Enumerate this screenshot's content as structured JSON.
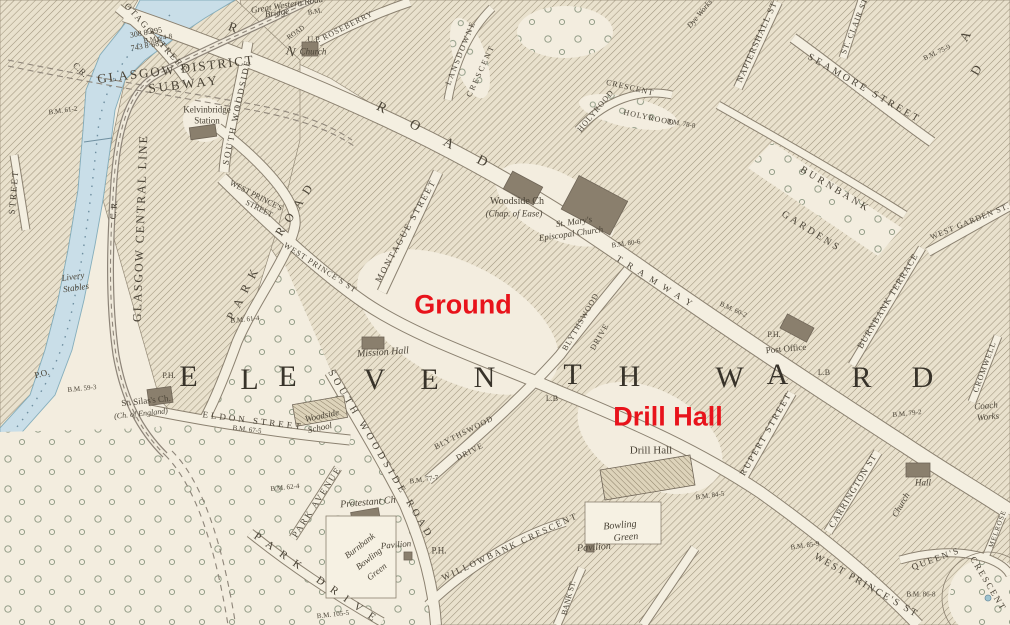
{
  "map": {
    "red_annotations": {
      "ground": "Ground",
      "drill_hall": "Drill Hall"
    },
    "ward_text": "ELEVENTH WARD",
    "colors": {
      "paper": "#f3eddf",
      "ink": "#4a4336",
      "water": "#c9dee8",
      "hatch": "#a0957e",
      "annotation_red": "#e8131b"
    },
    "labels": [
      {
        "name": "otago-street",
        "text": "OTAGO STREET",
        "x": 156,
        "y": 38,
        "rot": 48,
        "fs": 9,
        "ls": 2
      },
      {
        "name": "left-street",
        "text": "STREET",
        "x": 14,
        "y": 192,
        "rot": -85,
        "fs": 9,
        "ls": 2
      },
      {
        "name": "cr-upper",
        "text": "C.R.",
        "x": 80,
        "y": 70,
        "rot": 45,
        "fs": 9
      },
      {
        "name": "subway-line1",
        "text": "GLASGOW DISTRICT",
        "x": 176,
        "y": 69,
        "rot": -7,
        "fs": 13,
        "ls": 2
      },
      {
        "name": "subway-line2",
        "text": "SUBWAY",
        "x": 184,
        "y": 84,
        "rot": -7,
        "fs": 13,
        "ls": 3
      },
      {
        "name": "plot-308",
        "text": "308 8·895",
        "x": 146,
        "y": 33,
        "rot": -10,
        "fs": 8
      },
      {
        "name": "bm-74-8",
        "text": "B.M. 74-8",
        "x": 158,
        "y": 39,
        "rot": -10,
        "fs": 7
      },
      {
        "name": "plot-743",
        "text": "743 8·885",
        "x": 147,
        "y": 46,
        "rot": -10,
        "fs": 8
      },
      {
        "name": "bm-61-2",
        "text": "B.M. 61-2",
        "x": 63,
        "y": 111,
        "rot": -8,
        "fs": 7
      },
      {
        "name": "great-western-road",
        "text": "Great Western Road",
        "x": 287,
        "y": 5,
        "rot": -9,
        "fs": 9,
        "style": "it"
      },
      {
        "name": "gwr-bridge",
        "text": "Bridge",
        "x": 277,
        "y": 13,
        "rot": -9,
        "fs": 9,
        "style": "it"
      },
      {
        "name": "gwr-bridge-bm",
        "text": "B.M.",
        "x": 315,
        "y": 12,
        "rot": -9,
        "fs": 7
      },
      {
        "name": "roseberry",
        "text": "ROSEBERRY",
        "x": 348,
        "y": 26,
        "rot": -27,
        "fs": 8,
        "ls": 1
      },
      {
        "name": "road-small",
        "text": "ROAD",
        "x": 296,
        "y": 33,
        "rot": -35,
        "fs": 7
      },
      {
        "name": "up-church-1",
        "text": "U.P.",
        "x": 314,
        "y": 40,
        "rot": 0,
        "fs": 8
      },
      {
        "name": "up-church-2",
        "text": "Church",
        "x": 313,
        "y": 52,
        "rot": 0,
        "fs": 9,
        "style": "it"
      },
      {
        "name": "gwr-letter-r",
        "text": "R",
        "x": 233,
        "y": 27,
        "rot": 20,
        "fs": 13
      },
      {
        "name": "gwr-letter-n",
        "text": "N",
        "x": 291,
        "y": 51,
        "rot": 20,
        "fs": 13
      },
      {
        "name": "lansdowne-1",
        "text": "LANSDOWNE",
        "x": 461,
        "y": 53,
        "rot": -68,
        "fs": 8,
        "ls": 2
      },
      {
        "name": "lansdowne-2",
        "text": "CRESCENT",
        "x": 481,
        "y": 71,
        "rot": -65,
        "fs": 8,
        "ls": 2
      },
      {
        "name": "cr-mid",
        "text": "C. R.",
        "x": 114,
        "y": 210,
        "rot": -85,
        "fs": 9
      },
      {
        "name": "glasgow-central-line",
        "text": "GLASGOW CENTRAL LINE",
        "x": 140,
        "y": 228,
        "rot": -88,
        "fs": 12,
        "ls": 2
      },
      {
        "name": "kelvinbridge-station-1",
        "text": "Kelvinbridge",
        "x": 207,
        "y": 110,
        "rot": 0,
        "fs": 9
      },
      {
        "name": "kelvinbridge-station-2",
        "text": "Station",
        "x": 207,
        "y": 121,
        "rot": 0,
        "fs": 9
      },
      {
        "name": "south-woodside",
        "text": "SOUTH WOODSIDE",
        "x": 237,
        "y": 112,
        "rot": -78,
        "fs": 9,
        "ls": 2
      },
      {
        "name": "park-road-1",
        "text": "ROAD",
        "x": 296,
        "y": 207,
        "rot": -57,
        "fs": 12,
        "ls": 8
      },
      {
        "name": "park-road-2",
        "text": "PARK",
        "x": 244,
        "y": 291,
        "rot": -63,
        "fs": 12,
        "ls": 8
      },
      {
        "name": "west-princes-street-1a",
        "text": "WEST PRINCE'S",
        "x": 256,
        "y": 196,
        "rot": 27,
        "fs": 8
      },
      {
        "name": "west-princes-street-1b",
        "text": "STREET",
        "x": 259,
        "y": 209,
        "rot": 27,
        "fs": 8
      },
      {
        "name": "gwr-road-letters",
        "text": "ROAD",
        "x": 444,
        "y": 142,
        "rot": 28,
        "fs": 14,
        "ls": 28
      },
      {
        "name": "west-princes-st-2",
        "text": "WEST PRINCE'S ST",
        "x": 320,
        "y": 268,
        "rot": 33,
        "fs": 8,
        "ls": 1
      },
      {
        "name": "montague-street",
        "text": "MONTAGUE STREET",
        "x": 406,
        "y": 231,
        "rot": -61,
        "fs": 9,
        "ls": 2
      },
      {
        "name": "woodside-church",
        "text": "Woodside Ch",
        "x": 517,
        "y": 202,
        "rot": 0,
        "fs": 10
      },
      {
        "name": "chap-of-ease",
        "text": "(Chap. of Ease)",
        "x": 514,
        "y": 214,
        "rot": 0,
        "fs": 9,
        "style": "it"
      },
      {
        "name": "st-marys-1",
        "text": "St. Mary's",
        "x": 574,
        "y": 222,
        "rot": -8,
        "fs": 9,
        "style": "it"
      },
      {
        "name": "st-marys-2",
        "text": "Episcopal Church",
        "x": 571,
        "y": 234,
        "rot": -8,
        "fs": 9,
        "style": "it"
      },
      {
        "name": "bm-80-6",
        "text": "B.M. 80-6",
        "x": 626,
        "y": 244,
        "rot": -8,
        "fs": 7
      },
      {
        "name": "tramway",
        "text": "TRAMWAY",
        "x": 657,
        "y": 283,
        "rot": 32,
        "fs": 9,
        "ls": 7
      },
      {
        "name": "bm-60-2",
        "text": "B.M. 60-2",
        "x": 733,
        "y": 310,
        "rot": 25,
        "fs": 7
      },
      {
        "name": "ph-post-office",
        "text": "P.H.",
        "x": 774,
        "y": 335,
        "rot": 0,
        "fs": 8
      },
      {
        "name": "post-office",
        "text": "Post Office",
        "x": 786,
        "y": 349,
        "rot": -5,
        "fs": 9
      },
      {
        "name": "letter-box-1",
        "text": "L.B",
        "x": 552,
        "y": 399,
        "rot": 0,
        "fs": 8
      },
      {
        "name": "letter-box-2",
        "text": "L.B",
        "x": 824,
        "y": 373,
        "rot": 0,
        "fs": 8
      },
      {
        "name": "blythswood-n",
        "text": "BLYTHSWOOD",
        "x": 581,
        "y": 322,
        "rot": -60,
        "fs": 8,
        "ls": 1
      },
      {
        "name": "blythswood-n-drive",
        "text": "DRIVE",
        "x": 600,
        "y": 337,
        "rot": -60,
        "fs": 8,
        "ls": 1
      },
      {
        "name": "ward-letter-e1",
        "text": "E",
        "x": 189,
        "y": 377,
        "rot": 0,
        "fs": 30,
        "style": "ward"
      },
      {
        "name": "ward-letter-l",
        "text": "L",
        "x": 250,
        "y": 380,
        "rot": 0,
        "fs": 30,
        "style": "ward"
      },
      {
        "name": "ward-letter-e2",
        "text": "E",
        "x": 288,
        "y": 377,
        "rot": 0,
        "fs": 30,
        "style": "ward"
      },
      {
        "name": "ward-letter-v",
        "text": "V",
        "x": 375,
        "y": 380,
        "rot": 0,
        "fs": 30,
        "style": "ward"
      },
      {
        "name": "ward-letter-e3",
        "text": "E",
        "x": 430,
        "y": 380,
        "rot": 0,
        "fs": 30,
        "style": "ward"
      },
      {
        "name": "ward-letter-n",
        "text": "N",
        "x": 485,
        "y": 378,
        "rot": 0,
        "fs": 30,
        "style": "ward"
      },
      {
        "name": "ward-letter-t",
        "text": "T",
        "x": 573,
        "y": 375,
        "rot": 0,
        "fs": 30,
        "style": "ward"
      },
      {
        "name": "ward-letter-h",
        "text": "H",
        "x": 630,
        "y": 377,
        "rot": 0,
        "fs": 30,
        "style": "ward"
      },
      {
        "name": "ward-letter-w",
        "text": "W",
        "x": 730,
        "y": 378,
        "rot": 0,
        "fs": 30,
        "style": "ward"
      },
      {
        "name": "ward-letter-a",
        "text": "A",
        "x": 778,
        "y": 375,
        "rot": 0,
        "fs": 30,
        "style": "ward"
      },
      {
        "name": "ward-letter-r",
        "text": "R",
        "x": 862,
        "y": 378,
        "rot": 0,
        "fs": 30,
        "style": "ward"
      },
      {
        "name": "ward-letter-d",
        "text": "D",
        "x": 923,
        "y": 378,
        "rot": 0,
        "fs": 30,
        "style": "ward"
      },
      {
        "name": "mission-hall",
        "text": "Mission Hall",
        "x": 383,
        "y": 353,
        "rot": -4,
        "fs": 10,
        "style": "it"
      },
      {
        "name": "eldon-street",
        "text": "ELDON STREET",
        "x": 253,
        "y": 421,
        "rot": 7,
        "fs": 9,
        "ls": 3
      },
      {
        "name": "bm-67-5",
        "text": "B.M. 67-5",
        "x": 247,
        "y": 430,
        "rot": 7,
        "fs": 7
      },
      {
        "name": "woodside-school-1",
        "text": "Woodside",
        "x": 322,
        "y": 416,
        "rot": -12,
        "fs": 9,
        "style": "it"
      },
      {
        "name": "woodside-school-2",
        "text": "School",
        "x": 320,
        "y": 428,
        "rot": -12,
        "fs": 9,
        "style": "it"
      },
      {
        "name": "st-silas-1",
        "text": "St. Silas's Ch.",
        "x": 146,
        "y": 401,
        "rot": -6,
        "fs": 9
      },
      {
        "name": "st-silas-2",
        "text": "(Ch. of England)",
        "x": 141,
        "y": 414,
        "rot": -6,
        "fs": 8,
        "style": "it"
      },
      {
        "name": "post-office-west",
        "text": "P.O.",
        "x": 42,
        "y": 374,
        "rot": -15,
        "fs": 9
      },
      {
        "name": "bm-59-3",
        "text": "B.M. 59-3",
        "x": 82,
        "y": 389,
        "rot": -6,
        "fs": 7
      },
      {
        "name": "ph-west",
        "text": "P.H.",
        "x": 169,
        "y": 376,
        "rot": 0,
        "fs": 8
      },
      {
        "name": "livery-stables-1",
        "text": "Livery",
        "x": 73,
        "y": 277,
        "rot": -8,
        "fs": 9,
        "style": "it"
      },
      {
        "name": "livery-stables-2",
        "text": "Stables",
        "x": 76,
        "y": 288,
        "rot": -8,
        "fs": 9,
        "style": "it"
      },
      {
        "name": "south-woodside-road",
        "text": "SOUTH WOODSIDE ROAD",
        "x": 380,
        "y": 455,
        "rot": 59,
        "fs": 10,
        "ls": 4
      },
      {
        "name": "blythswood-s",
        "text": "BLYTHSWOOD",
        "x": 464,
        "y": 433,
        "rot": -27,
        "fs": 8,
        "ls": 1
      },
      {
        "name": "blythswood-s-drive",
        "text": "DRIVE",
        "x": 470,
        "y": 452,
        "rot": -27,
        "fs": 8,
        "ls": 1
      },
      {
        "name": "bm-77-7",
        "text": "B.M. 77-7",
        "x": 424,
        "y": 480,
        "rot": -8,
        "fs": 7
      },
      {
        "name": "park-avenue",
        "text": "PARK AVENUE",
        "x": 317,
        "y": 502,
        "rot": -57,
        "fs": 9,
        "ls": 2
      },
      {
        "name": "protestant-church",
        "text": "Protestant Ch",
        "x": 368,
        "y": 503,
        "rot": -5,
        "fs": 10,
        "style": "it"
      },
      {
        "name": "burnbank-bowling-1",
        "text": "Burnbank",
        "x": 360,
        "y": 546,
        "rot": -38,
        "fs": 9,
        "style": "it"
      },
      {
        "name": "burnbank-bowling-2",
        "text": "Bowling",
        "x": 369,
        "y": 559,
        "rot": -38,
        "fs": 9,
        "style": "it"
      },
      {
        "name": "burnbank-bowling-3",
        "text": "Green",
        "x": 377,
        "y": 572,
        "rot": -38,
        "fs": 9,
        "style": "it"
      },
      {
        "name": "pavilion-west",
        "text": "Pavilion",
        "x": 396,
        "y": 545,
        "rot": -5,
        "fs": 9,
        "style": "it"
      },
      {
        "name": "ph-center",
        "text": "P.H.",
        "x": 439,
        "y": 551,
        "rot": 0,
        "fs": 9
      },
      {
        "name": "willowbank-crescent",
        "text": "WILLOWBANK CRESCENT",
        "x": 510,
        "y": 547,
        "rot": -25,
        "fs": 9,
        "ls": 2
      },
      {
        "name": "bank-st",
        "text": "BANK ST.",
        "x": 569,
        "y": 598,
        "rot": -75,
        "fs": 8
      },
      {
        "name": "park-drive",
        "text": "PARK DRIVE",
        "x": 318,
        "y": 580,
        "rot": 35,
        "fs": 11,
        "ls": 9
      },
      {
        "name": "bm-105-5",
        "text": "B.M. 105-5",
        "x": 333,
        "y": 615,
        "rot": -6,
        "fs": 7
      },
      {
        "name": "bm-62-4",
        "text": "B.M. 62-4",
        "x": 285,
        "y": 488,
        "rot": -6,
        "fs": 7
      },
      {
        "name": "bm-61-4",
        "text": "B.M. 61-4",
        "x": 245,
        "y": 320,
        "rot": -6,
        "fs": 7
      },
      {
        "name": "drill-hall-building-label",
        "text": "Drill Hall",
        "x": 651,
        "y": 451,
        "rot": 0,
        "fs": 11
      },
      {
        "name": "rupert-street",
        "text": "RUPERT STREET",
        "x": 766,
        "y": 434,
        "rot": -60,
        "fs": 9,
        "ls": 2
      },
      {
        "name": "carrington-st",
        "text": "CARRINGTON ST",
        "x": 853,
        "y": 491,
        "rot": -59,
        "fs": 9,
        "ls": 1
      },
      {
        "name": "bm-84-5",
        "text": "B.M. 84-5",
        "x": 710,
        "y": 496,
        "rot": -8,
        "fs": 7
      },
      {
        "name": "bm-85-9",
        "text": "B.M. 85-9",
        "x": 805,
        "y": 546,
        "rot": -8,
        "fs": 7
      },
      {
        "name": "bowling-green-e-1",
        "text": "Bowling",
        "x": 620,
        "y": 526,
        "rot": -5,
        "fs": 10,
        "style": "it"
      },
      {
        "name": "bowling-green-e-2",
        "text": "Green",
        "x": 626,
        "y": 538,
        "rot": -5,
        "fs": 10,
        "style": "it"
      },
      {
        "name": "pavilion-east",
        "text": "Pavilion",
        "x": 594,
        "y": 548,
        "rot": -4,
        "fs": 10,
        "style": "it"
      },
      {
        "name": "west-princes-st-3",
        "text": "WEST PRINCE'S ST",
        "x": 866,
        "y": 586,
        "rot": 30,
        "fs": 10,
        "ls": 2
      },
      {
        "name": "queens-crescent-1",
        "text": "QUEEN'S",
        "x": 936,
        "y": 559,
        "rot": -20,
        "fs": 9,
        "ls": 2
      },
      {
        "name": "queens-crescent-2",
        "text": "CRESCENT",
        "x": 988,
        "y": 584,
        "rot": 59,
        "fs": 9,
        "ls": 2
      },
      {
        "name": "bm-86-8",
        "text": "B.M. 86-8",
        "x": 921,
        "y": 595,
        "rot": 0,
        "fs": 7
      },
      {
        "name": "hall-ne",
        "text": "Hall",
        "x": 923,
        "y": 483,
        "rot": 0,
        "fs": 9,
        "style": "it"
      },
      {
        "name": "church-vertical",
        "text": "Church",
        "x": 901,
        "y": 505,
        "rot": -60,
        "fs": 9,
        "style": "it"
      },
      {
        "name": "melrose",
        "text": "MELROSE",
        "x": 998,
        "y": 529,
        "rot": -70,
        "fs": 7,
        "ls": 1
      },
      {
        "name": "coach-works-1",
        "text": "Coach",
        "x": 986,
        "y": 406,
        "rot": -5,
        "fs": 9,
        "style": "it"
      },
      {
        "name": "coach-works-2",
        "text": "Works",
        "x": 988,
        "y": 417,
        "rot": -5,
        "fs": 9,
        "style": "it"
      },
      {
        "name": "bm-79-2",
        "text": "B.M. 79-2",
        "x": 907,
        "y": 414,
        "rot": -6,
        "fs": 7
      },
      {
        "name": "cromwell",
        "text": "CROMWELL",
        "x": 985,
        "y": 367,
        "rot": -70,
        "fs": 8,
        "ls": 1
      },
      {
        "name": "burnbank-terrace",
        "text": "BURNBANK TERRACE",
        "x": 888,
        "y": 301,
        "rot": -59,
        "fs": 9,
        "ls": 1
      },
      {
        "name": "burnbank-gardens-1",
        "text": "BURNBANK",
        "x": 835,
        "y": 190,
        "rot": 31,
        "fs": 10,
        "ls": 3
      },
      {
        "name": "burnbank-gardens-2",
        "text": "GARDENS",
        "x": 811,
        "y": 232,
        "rot": 32,
        "fs": 10,
        "ls": 3
      },
      {
        "name": "west-garden-st",
        "text": "WEST GARDEN ST.",
        "x": 970,
        "y": 222,
        "rot": -22,
        "fs": 8,
        "ls": 1
      },
      {
        "name": "holyrood-1",
        "text": "HOLYROOD",
        "x": 596,
        "y": 111,
        "rot": -50,
        "fs": 8,
        "ls": 1
      },
      {
        "name": "holyrood-crescent",
        "text": "CRESCENT",
        "x": 630,
        "y": 88,
        "rot": 13,
        "fs": 8,
        "ls": 1
      },
      {
        "name": "holyrood-2",
        "text": "HOLYROOD",
        "x": 649,
        "y": 118,
        "rot": 12,
        "fs": 8,
        "ls": 1
      },
      {
        "name": "bm-78-8",
        "text": "B.M. 78-8",
        "x": 681,
        "y": 124,
        "rot": 10,
        "fs": 7
      },
      {
        "name": "napiershall-st",
        "text": "NAPIERSHALL ST",
        "x": 757,
        "y": 42,
        "rot": -66,
        "fs": 9,
        "ls": 1
      },
      {
        "name": "st-clair-st",
        "text": "ST. CLAIR ST",
        "x": 855,
        "y": 26,
        "rot": -68,
        "fs": 8,
        "ls": 1
      },
      {
        "name": "seamore-street",
        "text": "SEAMORE STREET",
        "x": 864,
        "y": 89,
        "rot": 30,
        "fs": 10,
        "ls": 3
      },
      {
        "name": "bm-75-9",
        "text": "B.M. 75-9",
        "x": 937,
        "y": 53,
        "rot": -25,
        "fs": 7
      },
      {
        "name": "road-letter-a",
        "text": "A",
        "x": 965,
        "y": 36,
        "rot": -60,
        "fs": 13
      },
      {
        "name": "road-letter-d",
        "text": "D",
        "x": 976,
        "y": 70,
        "rot": -60,
        "fs": 13
      },
      {
        "name": "dye-works",
        "text": "Dye Works",
        "x": 700,
        "y": 14,
        "rot": -50,
        "fs": 8,
        "style": "it"
      }
    ]
  }
}
